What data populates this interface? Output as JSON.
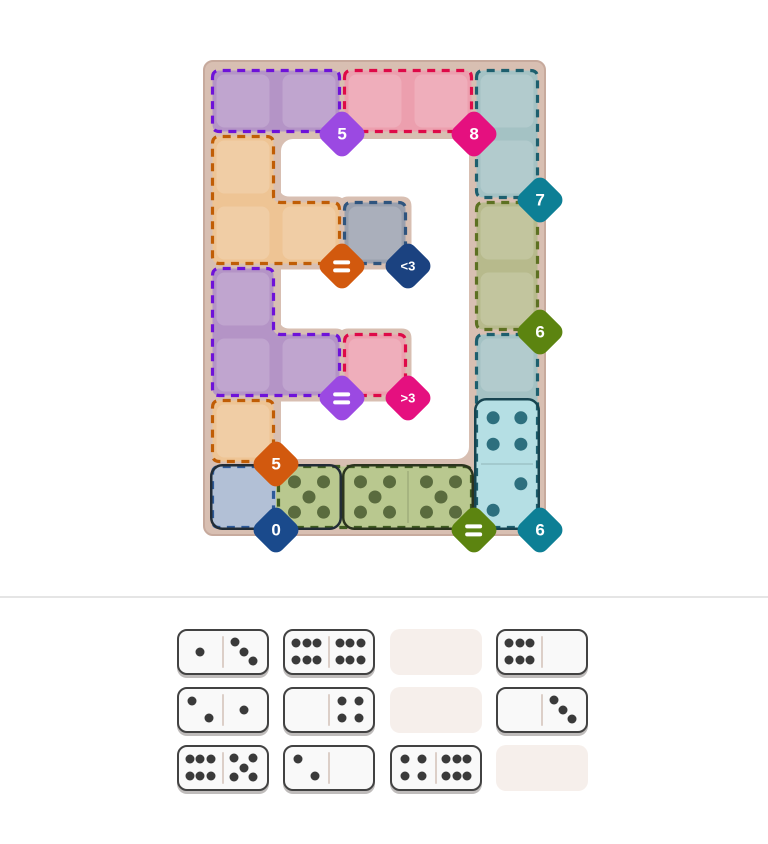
{
  "board": {
    "background_color": "#d8bfb2",
    "border_color": "#c7aa9d",
    "hole_color": "#ffffff",
    "grid": {
      "cols": 5,
      "rows": 7
    },
    "regions": [
      {
        "name": "purple-top",
        "cells": [
          [
            0,
            0
          ],
          [
            1,
            0
          ]
        ],
        "fill": "#b494c6",
        "stroke": "#6e12d9",
        "badge": {
          "label": "5",
          "color": "#9b49e2",
          "at": [
            2,
            1
          ]
        }
      },
      {
        "name": "pink-top",
        "cells": [
          [
            2,
            0
          ],
          [
            3,
            0
          ]
        ],
        "fill": "#ec9fae",
        "stroke": "#de0a48",
        "badge": {
          "label": "8",
          "color": "#e5107f",
          "at": [
            4,
            1
          ]
        }
      },
      {
        "name": "teal-top-right",
        "cells": [
          [
            4,
            0
          ],
          [
            4,
            1
          ]
        ],
        "fill": "#a4c2c4",
        "stroke": "#1d5f6e",
        "badge": {
          "label": "7",
          "color": "#0d7f95",
          "at": [
            5,
            2
          ]
        }
      },
      {
        "name": "orange-left",
        "cells": [
          [
            0,
            1
          ],
          [
            0,
            2
          ],
          [
            1,
            2
          ]
        ],
        "fill": "#eec494",
        "stroke": "#c05d05",
        "badge": {
          "label": "=",
          "color": "#d2590e",
          "at": [
            2,
            3
          ]
        }
      },
      {
        "name": "slate-center",
        "cells": [
          [
            2,
            2
          ]
        ],
        "fill": "#9aa0ae",
        "stroke": "#2f547e",
        "badge": {
          "label": "<3",
          "color": "#1b4280",
          "at": [
            3,
            3
          ]
        }
      },
      {
        "name": "olive-right",
        "cells": [
          [
            4,
            2
          ],
          [
            4,
            3
          ]
        ],
        "fill": "#b7ba8c",
        "stroke": "#5d7122",
        "badge": {
          "label": "6",
          "color": "#5c8410",
          "at": [
            5,
            4
          ]
        }
      },
      {
        "name": "purple-mid",
        "cells": [
          [
            0,
            3
          ],
          [
            0,
            4
          ],
          [
            1,
            4
          ]
        ],
        "fill": "#b494c6",
        "stroke": "#6e12d9",
        "badge": {
          "label": "=",
          "color": "#9b49e2",
          "at": [
            2,
            5
          ]
        }
      },
      {
        "name": "pink-mid",
        "cells": [
          [
            2,
            4
          ]
        ],
        "fill": "#ec9fae",
        "stroke": "#de0a48",
        "badge": {
          "label": ">3",
          "color": "#e5107f",
          "at": [
            3,
            5
          ]
        }
      },
      {
        "name": "orange-small",
        "cells": [
          [
            0,
            5
          ]
        ],
        "fill": "#eec494",
        "stroke": "#c05d05",
        "badge": {
          "label": "5",
          "color": "#d2590e",
          "at": [
            1,
            6
          ]
        }
      },
      {
        "name": "blue-corner",
        "cells": [
          [
            0,
            6
          ]
        ],
        "fill": "#b2c0d6",
        "stroke": "#2d5a99",
        "badge": {
          "label": "0",
          "color": "#1a4a8c",
          "at": [
            1,
            7
          ]
        }
      },
      {
        "name": "green-bottom",
        "cells": [
          [
            1,
            6
          ],
          [
            2,
            6
          ],
          [
            3,
            6
          ]
        ],
        "fill": "#b9c88f",
        "stroke": "#3f5c20",
        "badge": {
          "label": "=",
          "color": "#5c8410",
          "at": [
            4,
            7
          ]
        }
      },
      {
        "name": "teal-bottom-right",
        "cells": [
          [
            4,
            4
          ],
          [
            4,
            5
          ],
          [
            4,
            6
          ]
        ],
        "fill": "#a4c2c4",
        "stroke": "#1d5f6e",
        "badge": {
          "label": "6",
          "color": "#0d7f95",
          "at": [
            5,
            7
          ]
        }
      }
    ],
    "placed_dominoes": [
      {
        "name": "placed-domino-0-5",
        "cells": [
          [
            0,
            6
          ],
          [
            1,
            6
          ]
        ],
        "pips": [
          0,
          5
        ],
        "half_fills": [
          "#b2c0d6",
          "#b9c88f"
        ],
        "outline": "#222c36",
        "pip_color": "#5a6b3e",
        "show_divider": false
      },
      {
        "name": "placed-domino-5-5",
        "cells": [
          [
            2,
            6
          ],
          [
            3,
            6
          ]
        ],
        "pips": [
          5,
          5
        ],
        "half_fills": [
          "#b9c88f",
          "#b9c88f"
        ],
        "outline": "#2b341e",
        "pip_color": "#5a6b3e",
        "show_divider": true
      },
      {
        "name": "placed-domino-4-2",
        "cells": [
          [
            4,
            5
          ],
          [
            4,
            6
          ]
        ],
        "pips": [
          4,
          2
        ],
        "half_fills": [
          "#b5dfe4",
          "#b5dfe4"
        ],
        "outline": "#174450",
        "pip_color": "#2d6f7e",
        "show_divider": true
      }
    ]
  },
  "tray": {
    "empty_slot_color": "#f6efeb",
    "domino_face_color": "#f9f9f9",
    "domino_border_color": "#424242",
    "pip_color": "#3a3a3a",
    "divider_color": "#dccfc8",
    "slots": [
      [
        [
          1,
          3
        ],
        [
          6,
          6
        ],
        null,
        [
          6,
          0
        ]
      ],
      [
        [
          2,
          1
        ],
        [
          0,
          4
        ],
        null,
        [
          0,
          3
        ]
      ],
      [
        [
          6,
          5
        ],
        [
          2,
          0
        ],
        [
          4,
          6
        ],
        null
      ]
    ]
  },
  "divider_color": "#e5e5e5"
}
